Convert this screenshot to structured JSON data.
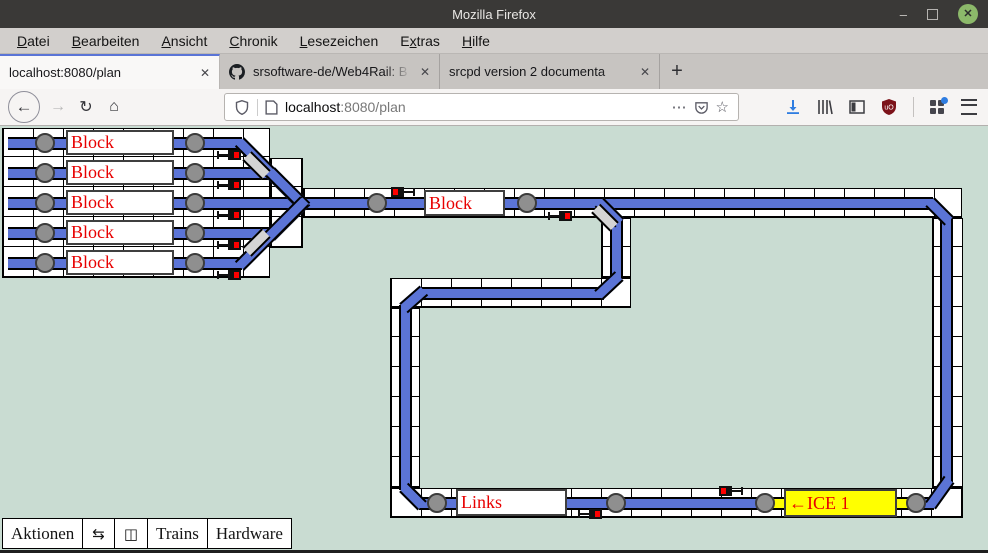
{
  "window": {
    "title": "Mozilla Firefox",
    "minimize_glyph": "–",
    "close_glyph": "✕"
  },
  "menubar": {
    "items": [
      {
        "label": "Datei",
        "upos": 0
      },
      {
        "label": "Bearbeiten",
        "upos": 0
      },
      {
        "label": "Ansicht",
        "upos": 0
      },
      {
        "label": "Chronik",
        "upos": 0
      },
      {
        "label": "Lesezeichen",
        "upos": 0
      },
      {
        "label": "Extras",
        "upos": 1
      },
      {
        "label": "Hilfe",
        "upos": 0
      }
    ]
  },
  "tabbar": {
    "tabs": [
      {
        "title": "localhost:8080/plan",
        "favicon": "none",
        "active": true
      },
      {
        "title": "srsoftware-de/Web4Rail: B",
        "favicon": "github",
        "active": false
      },
      {
        "title": "srcpd version 2 documenta",
        "favicon": "none",
        "active": false
      }
    ],
    "close_glyph": "✕",
    "new_tab_glyph": "+"
  },
  "navbar": {
    "back_glyph": "←",
    "forward_glyph": "→",
    "reload_glyph": "↻",
    "home_glyph": "⌂",
    "url_host": "localhost",
    "url_rest": ":8080/plan",
    "more_glyph": "⋯",
    "star_glyph": "☆"
  },
  "toolbar": {
    "items": [
      {
        "label": "Aktionen",
        "kind": "text",
        "name": "actions-button"
      },
      {
        "label": "⇆",
        "kind": "icon",
        "name": "switches-button"
      },
      {
        "label": "◫",
        "kind": "icon",
        "name": "plan-button"
      },
      {
        "label": "Trains",
        "kind": "text",
        "name": "trains-button"
      },
      {
        "label": "Hardware",
        "kind": "text",
        "name": "hardware-button"
      }
    ]
  },
  "colors": {
    "track": "#5b74d6",
    "page_bg": "#c9dcd2",
    "label_red": "#e80000",
    "occupied_yellow": "#ffff00",
    "inactive_gray": "#d4d4d4",
    "contact_gray": "#8f8f8f"
  },
  "plan": {
    "panels": [
      [
        2,
        128,
        268,
        150
      ],
      [
        270,
        158,
        33,
        90
      ],
      [
        303,
        188,
        659,
        30
      ],
      [
        601,
        218,
        30,
        60
      ],
      [
        390,
        278,
        241,
        30
      ],
      [
        390,
        308,
        30,
        180
      ],
      [
        390,
        488,
        573,
        30
      ],
      [
        932,
        218,
        31,
        270
      ]
    ],
    "tracks_h": [
      [
        8,
        242,
        143
      ],
      [
        8,
        272,
        173
      ],
      [
        8,
        933,
        203
      ],
      [
        8,
        272,
        233
      ],
      [
        8,
        242,
        263
      ],
      [
        421,
        604,
        293
      ],
      [
        419,
        934,
        503
      ]
    ],
    "tracks_v": [
      [
        616,
        218,
        279
      ],
      [
        405,
        305,
        490
      ],
      [
        946,
        217,
        482
      ]
    ],
    "diagonals": [
      [
        242,
        143,
        303,
        204
      ],
      [
        272,
        173,
        303,
        204
      ],
      [
        272,
        233,
        303,
        202
      ],
      [
        242,
        263,
        303,
        202
      ],
      [
        601,
        204,
        617,
        220
      ],
      [
        617,
        277,
        601,
        292
      ],
      [
        422,
        292,
        406,
        306
      ],
      [
        406,
        489,
        420,
        503
      ],
      [
        932,
        203,
        947,
        218
      ],
      [
        947,
        481,
        932,
        502
      ]
    ],
    "gray_segments": [
      [
        249,
        157,
        264,
        172
      ],
      [
        249,
        249,
        264,
        234
      ],
      [
        598,
        210,
        612,
        224
      ]
    ],
    "occupied_track": [
      770,
      914,
      503
    ],
    "contacts": [
      [
        45,
        143
      ],
      [
        195,
        143
      ],
      [
        45,
        173
      ],
      [
        195,
        173
      ],
      [
        45,
        203
      ],
      [
        195,
        203
      ],
      [
        45,
        233
      ],
      [
        195,
        233
      ],
      [
        45,
        263
      ],
      [
        195,
        263
      ],
      [
        377,
        203
      ],
      [
        527,
        203
      ],
      [
        437,
        503
      ],
      [
        616,
        503
      ],
      [
        765,
        503
      ],
      [
        916,
        503
      ]
    ],
    "signals": [
      {
        "x": 217,
        "y": 150,
        "red": "right"
      },
      {
        "x": 217,
        "y": 180,
        "red": "right"
      },
      {
        "x": 217,
        "y": 210,
        "red": "right"
      },
      {
        "x": 217,
        "y": 240,
        "red": "right"
      },
      {
        "x": 217,
        "y": 270,
        "red": "right"
      },
      {
        "x": 548,
        "y": 211,
        "red": "right"
      },
      {
        "x": 578,
        "y": 509,
        "red": "right"
      },
      {
        "x": 391,
        "y": 187,
        "red": "left"
      },
      {
        "x": 719,
        "y": 486,
        "red": "left"
      }
    ],
    "blocks": [
      {
        "label": "Block",
        "x": 66,
        "y": 130,
        "w": 108,
        "h": 25,
        "occupied": false
      },
      {
        "label": "Block",
        "x": 66,
        "y": 160,
        "w": 108,
        "h": 25,
        "occupied": false
      },
      {
        "label": "Block",
        "x": 66,
        "y": 190,
        "w": 108,
        "h": 25,
        "occupied": false
      },
      {
        "label": "Block",
        "x": 66,
        "y": 220,
        "w": 108,
        "h": 25,
        "occupied": false
      },
      {
        "label": "Block",
        "x": 66,
        "y": 250,
        "w": 108,
        "h": 25,
        "occupied": false
      },
      {
        "label": "Block",
        "x": 424,
        "y": 190,
        "w": 81,
        "h": 26,
        "occupied": false
      },
      {
        "label": "Links",
        "x": 456,
        "y": 489,
        "w": 111,
        "h": 27,
        "occupied": false
      },
      {
        "label": "←ICE 1",
        "x": 784,
        "y": 489,
        "w": 113,
        "h": 28,
        "occupied": true
      }
    ]
  }
}
